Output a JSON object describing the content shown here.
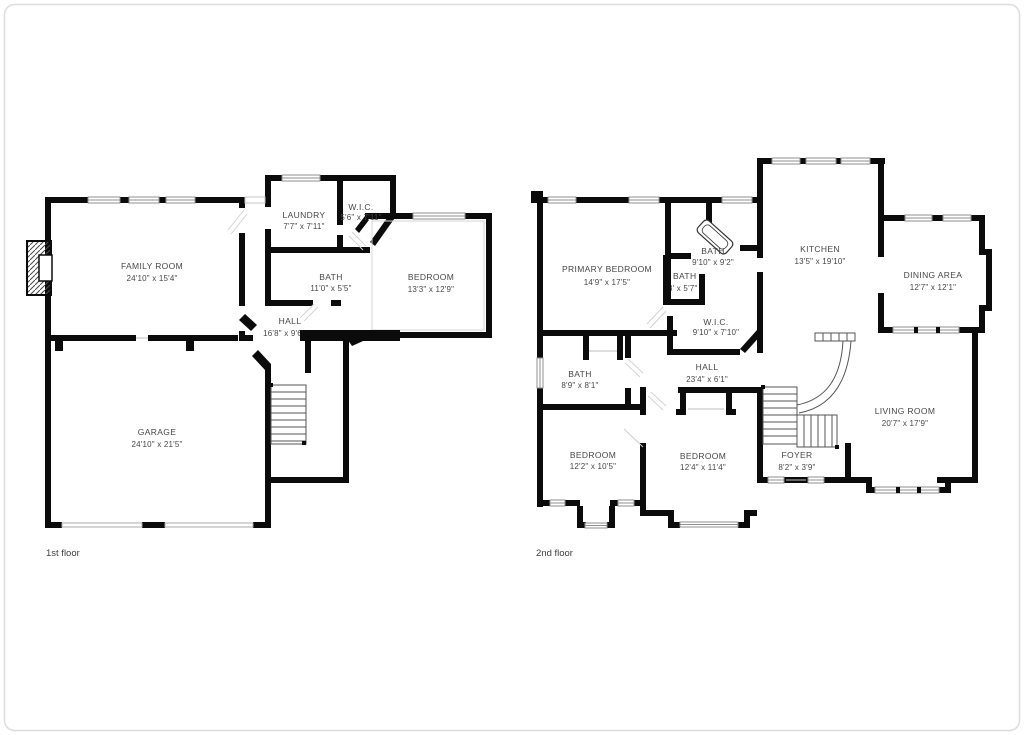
{
  "canvas": {
    "background": "#ffffff",
    "wall_color": "#0b0b0b",
    "text_color": "#474747",
    "window_stroke": "#8f8f8f",
    "border_color": "#dcdcdc"
  },
  "floors": [
    {
      "label": "1st floor",
      "rooms": [
        {
          "name": "FAMILY ROOM",
          "dims": "24'10\" x 15'4\""
        },
        {
          "name": "LAUNDRY",
          "dims": "7'7\" x 7'11\""
        },
        {
          "name": "W.I.C.",
          "dims": "5'6\" x 7'11\""
        },
        {
          "name": "BATH",
          "dims": "11'0\" x 5'5\""
        },
        {
          "name": "BEDROOM",
          "dims": "13'3\" x 12'9\""
        },
        {
          "name": "HALL",
          "dims": "16'8\" x 9'6\""
        },
        {
          "name": "GARAGE",
          "dims": "24'10\" x 21'5\""
        }
      ]
    },
    {
      "label": "2nd floor",
      "rooms": [
        {
          "name": "PRIMARY BEDROOM",
          "dims": "14'9\" x 17'5\""
        },
        {
          "name": "BATH",
          "dims": "9'10\" x 9'2\""
        },
        {
          "name": "BATH",
          "dims": "3' x 5'7\""
        },
        {
          "name": "W.I.C.",
          "dims": "9'10\" x 7'10\""
        },
        {
          "name": "KITCHEN",
          "dims": "13'5\" x 19'10\""
        },
        {
          "name": "DINING AREA",
          "dims": "12'7\" x 12'1\""
        },
        {
          "name": "HALL",
          "dims": "23'4\" x 6'1\""
        },
        {
          "name": "BATH",
          "dims": "8'9\" x 8'1\""
        },
        {
          "name": "BEDROOM",
          "dims": "12'2\" x 10'5\""
        },
        {
          "name": "BEDROOM",
          "dims": "12'4\" x 11'4\""
        },
        {
          "name": "FOYER",
          "dims": "8'2\" x 3'9\""
        },
        {
          "name": "LIVING ROOM",
          "dims": "20'7\" x 17'9\""
        }
      ]
    }
  ]
}
